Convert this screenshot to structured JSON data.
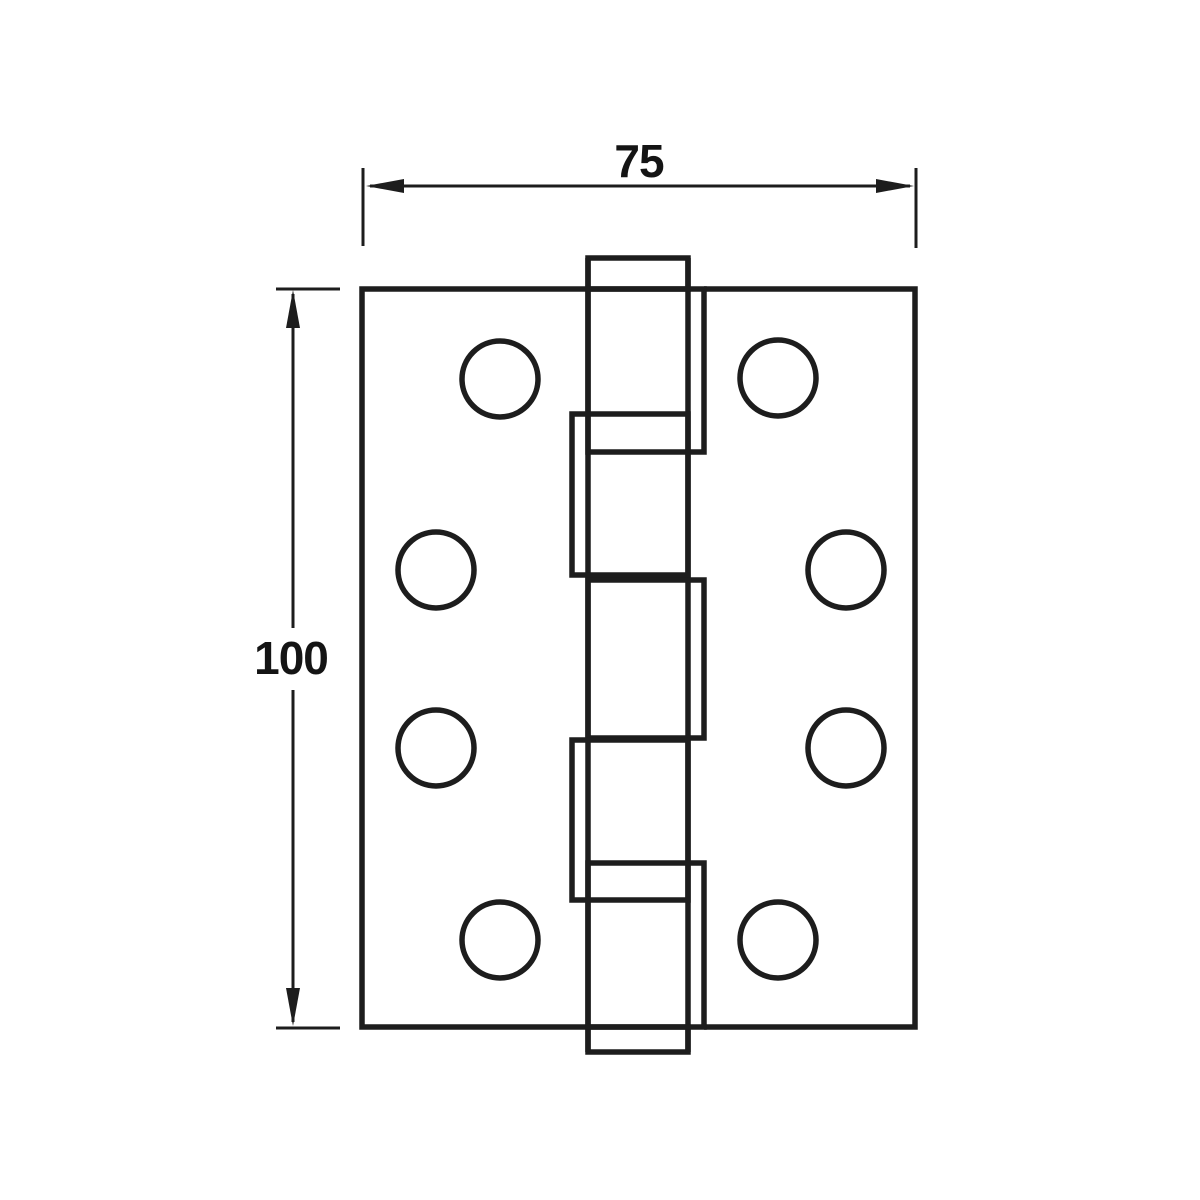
{
  "drawing": {
    "subject": "butt-hinge-front-elevation",
    "background_color": "#ffffff",
    "line_color": "#1d1d1d",
    "width_dimension": {
      "label": "75"
    },
    "height_dimension": {
      "label": "100"
    },
    "screw_hole_count": 8,
    "knuckle_segment_count": 5
  }
}
